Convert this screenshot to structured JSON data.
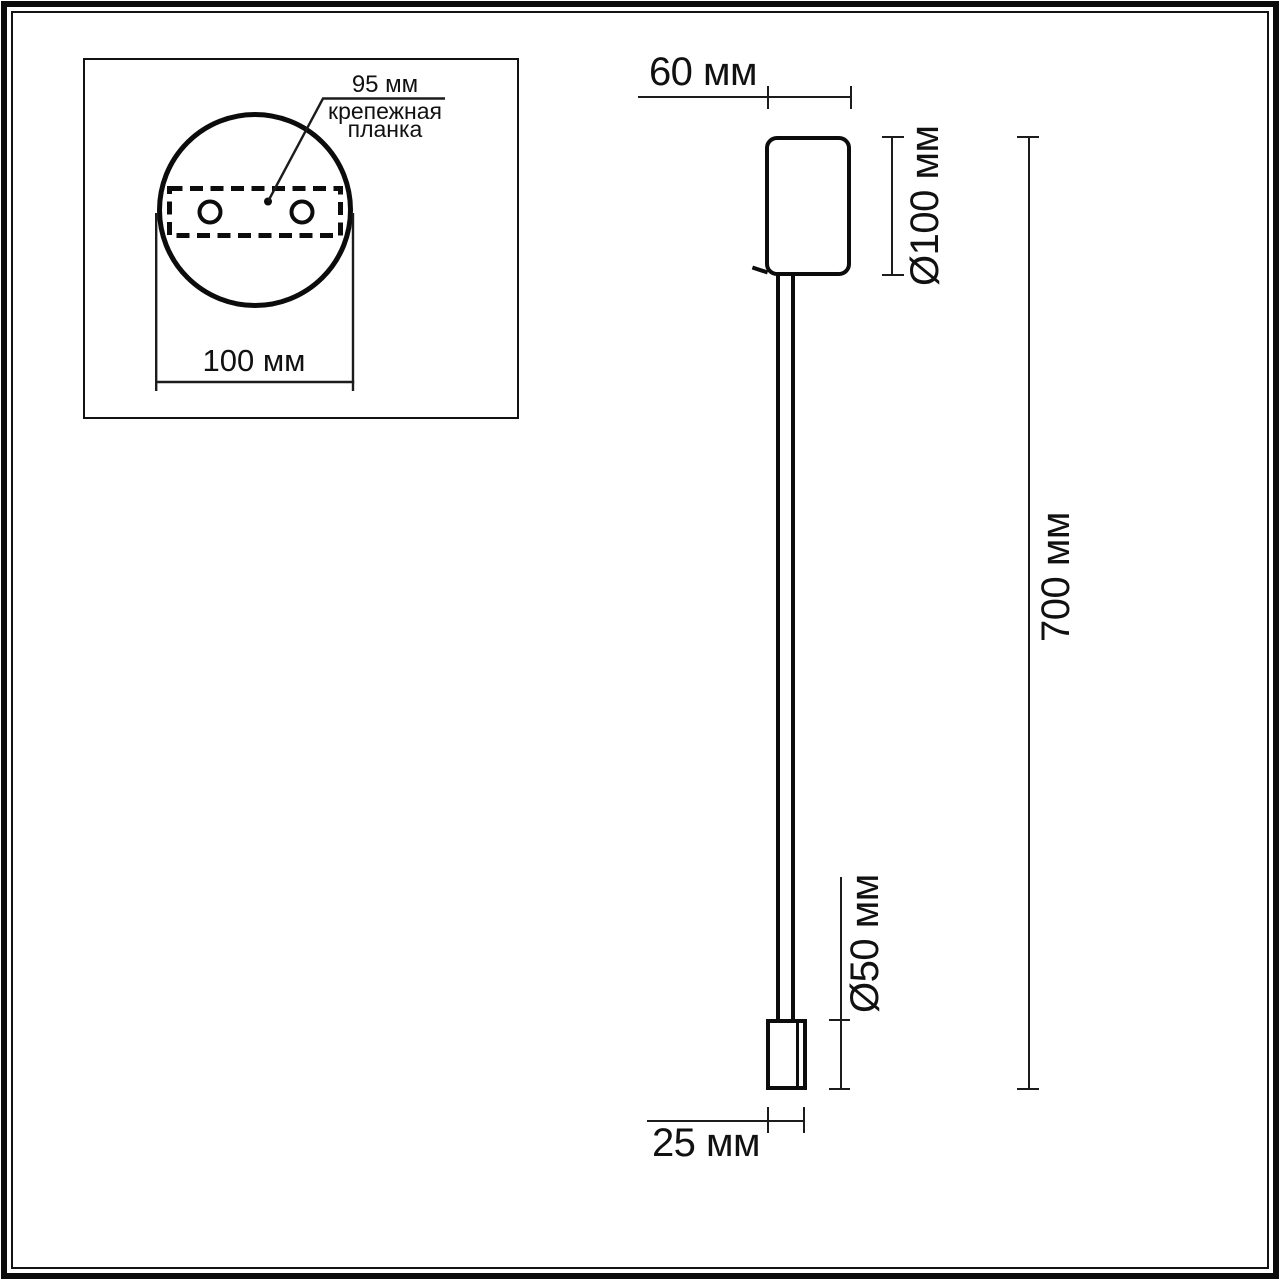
{
  "colors": {
    "background": "#ffffff",
    "object_line": "#0c0c0c",
    "dimension_line": "#1c1c1c",
    "text": "#111111"
  },
  "inset": {
    "hole_spacing": "95 мм",
    "mounting_bar_line1": "крепежная",
    "mounting_bar_line2": "планка",
    "width": "100 мм"
  },
  "side_view": {
    "top_width": "60 мм",
    "mount_diameter": "Ø100 мм",
    "overall_height": "700 мм",
    "head_diameter": "Ø50 мм",
    "head_width": "25 мм"
  }
}
